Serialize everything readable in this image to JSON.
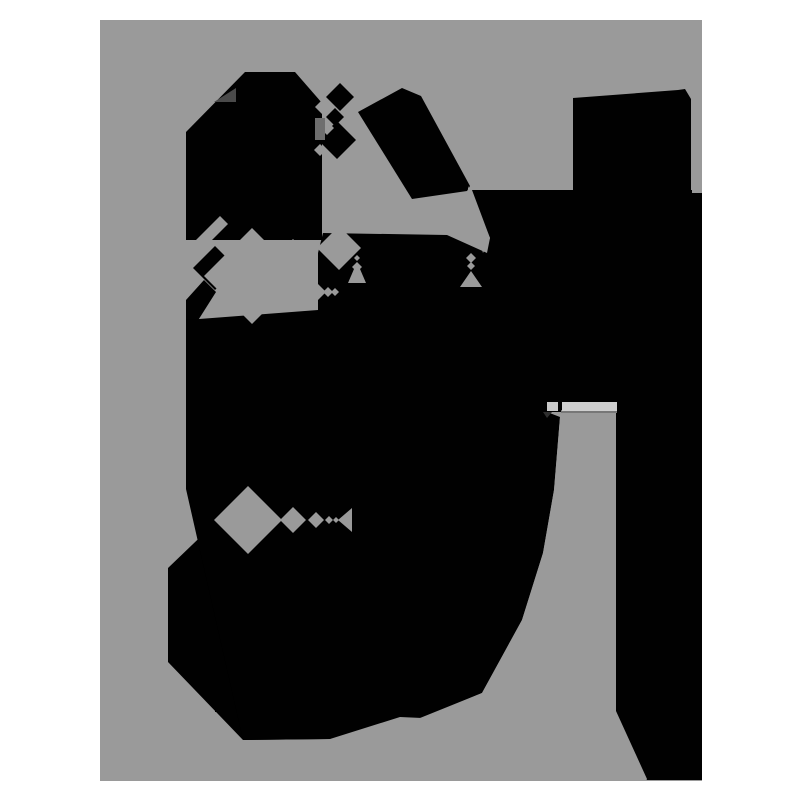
{
  "scene": {
    "description": "abstract-black-shapes-on-gray-canvas",
    "background_color": "#ffffff",
    "canvas": {
      "x": 100,
      "y": 20,
      "width": 602,
      "height": 761,
      "color": "#9a9a9a"
    },
    "palette": {
      "black": "#010101",
      "canvas_gray": "#9a9a9a",
      "dark_accent": "#4a4a4a",
      "mid_accent": "#6e6e6e",
      "bar_light": "#cfcfcf",
      "bar_stub": "#c9c9c9",
      "bar_shadow": "#777777",
      "stub_shadow": "#2e2e2e"
    },
    "shapes": [
      {
        "name": "blob-top-left",
        "type": "polygon",
        "fill": "#010101",
        "points": [
          [
            245,
            72
          ],
          [
            295,
            72
          ],
          [
            322,
            103
          ],
          [
            322,
            240
          ],
          [
            186,
            240
          ],
          [
            186,
            132
          ]
        ]
      },
      {
        "name": "waist-diamond",
        "type": "polygon",
        "fill": "#010101",
        "points": [
          [
            215,
            246
          ],
          [
            237,
            268
          ],
          [
            215,
            290
          ],
          [
            193,
            268
          ]
        ]
      },
      {
        "name": "waist-link",
        "type": "polygon",
        "fill": "#010101",
        "points": [
          [
            186,
            300
          ],
          [
            204,
            280
          ],
          [
            216,
            292
          ],
          [
            197,
            322
          ],
          [
            186,
            322
          ]
        ]
      },
      {
        "name": "left-mass",
        "type": "polygon",
        "fill": "#010101",
        "points": [
          [
            186,
            320
          ],
          [
            370,
            320
          ],
          [
            370,
            700
          ],
          [
            330,
            739
          ],
          [
            243,
            740
          ],
          [
            168,
            662
          ],
          [
            168,
            568
          ],
          [
            217,
            521
          ],
          [
            186,
            489
          ]
        ]
      },
      {
        "name": "central-mass",
        "type": "polygon",
        "fill": "#010101",
        "points": [
          [
            318,
            253
          ],
          [
            323,
            233
          ],
          [
            447,
            235
          ],
          [
            487,
            253
          ],
          [
            547,
            253
          ],
          [
            547,
            412
          ],
          [
            560,
            417
          ],
          [
            554,
            490
          ],
          [
            543,
            553
          ],
          [
            522,
            620
          ],
          [
            482,
            693
          ],
          [
            422,
            718
          ],
          [
            400,
            717
          ],
          [
            330,
            739
          ],
          [
            243,
            740
          ],
          [
            186,
            489
          ],
          [
            186,
            320
          ],
          [
            318,
            310
          ]
        ]
      },
      {
        "name": "slanted-band",
        "type": "polygon",
        "fill": "#010101",
        "points": [
          [
            358,
            112
          ],
          [
            402,
            88
          ],
          [
            421,
            96
          ],
          [
            470,
            186
          ],
          [
            467,
            191
          ],
          [
            412,
            199
          ]
        ]
      },
      {
        "name": "cluster-diamond-top",
        "type": "polygon",
        "fill": "#010101",
        "points": [
          [
            340,
            83
          ],
          [
            354,
            97
          ],
          [
            340,
            111
          ],
          [
            326,
            97
          ]
        ]
      },
      {
        "name": "cluster-diamond-mid",
        "type": "polygon",
        "fill": "#010101",
        "points": [
          [
            335,
            108
          ],
          [
            344,
            117
          ],
          [
            335,
            126
          ],
          [
            326,
            117
          ]
        ]
      },
      {
        "name": "cluster-diamond-bottom",
        "type": "polygon",
        "fill": "#010101",
        "points": [
          [
            337,
            121
          ],
          [
            356,
            140
          ],
          [
            337,
            159
          ],
          [
            318,
            140
          ]
        ]
      },
      {
        "name": "right-mega-mass",
        "type": "polygon",
        "fill": "#010101",
        "points": [
          [
            472,
            190
          ],
          [
            573,
            190
          ],
          [
            573,
            98
          ],
          [
            678,
            90
          ],
          [
            685,
            89
          ],
          [
            691,
            99
          ],
          [
            691,
            190
          ],
          [
            702,
            190
          ],
          [
            702,
            780
          ],
          [
            647,
            780
          ],
          [
            616,
            712
          ],
          [
            616,
            412
          ],
          [
            547,
            412
          ],
          [
            547,
            253
          ],
          [
            487,
            253
          ],
          [
            490,
            238
          ]
        ]
      },
      {
        "name": "tick-line",
        "type": "rect",
        "fill": "#010101",
        "x": 215,
        "y": 710,
        "w": 17,
        "h": 2
      },
      {
        "name": "corner-channel",
        "type": "polygon",
        "fill": "#9a9a9a",
        "points": [
          [
            176,
            260
          ],
          [
            220,
            216
          ],
          [
            228,
            224
          ],
          [
            184,
            268
          ]
        ]
      },
      {
        "name": "big-gray-diamond",
        "type": "polygon",
        "fill": "#9a9a9a",
        "points": [
          [
            252,
            228
          ],
          [
            300,
            276
          ],
          [
            252,
            324
          ],
          [
            204,
            276
          ]
        ]
      },
      {
        "name": "gray-diamond-a",
        "type": "polygon",
        "fill": "#9a9a9a",
        "points": [
          [
            293,
            239
          ],
          [
            311,
            257
          ],
          [
            293,
            275
          ],
          [
            275,
            257
          ]
        ]
      },
      {
        "name": "gray-diamond-b",
        "type": "polygon",
        "fill": "#9a9a9a",
        "points": [
          [
            292,
            270
          ],
          [
            310,
            288
          ],
          [
            292,
            306
          ],
          [
            274,
            288
          ]
        ]
      },
      {
        "name": "gray-diamond-c",
        "type": "polygon",
        "fill": "#9a9a9a",
        "points": [
          [
            339,
            226
          ],
          [
            361,
            248
          ],
          [
            339,
            270
          ],
          [
            317,
            248
          ]
        ]
      },
      {
        "name": "edge-notch-a",
        "type": "polygon",
        "fill": "#9a9a9a",
        "points": [
          [
            323,
            99
          ],
          [
            331,
            107
          ],
          [
            323,
            115
          ],
          [
            315,
            107
          ]
        ]
      },
      {
        "name": "edge-notch-b",
        "type": "polygon",
        "fill": "#9a9a9a",
        "points": [
          [
            327,
            121
          ],
          [
            334,
            128
          ],
          [
            327,
            135
          ],
          [
            320,
            128
          ]
        ]
      },
      {
        "name": "edge-notch-c",
        "type": "polygon",
        "fill": "#9a9a9a",
        "points": [
          [
            320,
            144
          ],
          [
            326,
            150
          ],
          [
            320,
            156
          ],
          [
            314,
            150
          ]
        ]
      },
      {
        "name": "chain292-a",
        "type": "polygon",
        "fill": "#9a9a9a",
        "points": [
          [
            317,
            283
          ],
          [
            326,
            292
          ],
          [
            317,
            301
          ],
          [
            308,
            292
          ]
        ]
      },
      {
        "name": "chain292-b",
        "type": "polygon",
        "fill": "#9a9a9a",
        "points": [
          [
            328,
            287
          ],
          [
            333,
            292
          ],
          [
            328,
            297
          ],
          [
            323,
            292
          ]
        ]
      },
      {
        "name": "chain292-c",
        "type": "polygon",
        "fill": "#9a9a9a",
        "points": [
          [
            335,
            288
          ],
          [
            339,
            292
          ],
          [
            335,
            296
          ],
          [
            331,
            292
          ]
        ]
      },
      {
        "name": "dot-diamond-a",
        "type": "polygon",
        "fill": "#9a9a9a",
        "points": [
          [
            357,
            255
          ],
          [
            360,
            258
          ],
          [
            357,
            261
          ],
          [
            354,
            258
          ]
        ]
      },
      {
        "name": "dot-diamond-b",
        "type": "polygon",
        "fill": "#9a9a9a",
        "points": [
          [
            357,
            262
          ],
          [
            362,
            267
          ],
          [
            357,
            272
          ],
          [
            352,
            267
          ]
        ]
      },
      {
        "name": "wedge-right",
        "type": "polygon",
        "fill": "#9a9a9a",
        "points": [
          [
            357,
            262
          ],
          [
            366,
            283
          ],
          [
            348,
            283
          ]
        ]
      },
      {
        "name": "neck-gap",
        "type": "polygon",
        "fill": "#9a9a9a",
        "points": [
          [
            468,
            186
          ],
          [
            490,
            238
          ],
          [
            483,
            253
          ],
          [
            468,
            203
          ]
        ]
      },
      {
        "name": "drip-diamond-a",
        "type": "polygon",
        "fill": "#9a9a9a",
        "points": [
          [
            471,
            253
          ],
          [
            476,
            258
          ],
          [
            471,
            263
          ],
          [
            466,
            258
          ]
        ]
      },
      {
        "name": "drip-diamond-b",
        "type": "polygon",
        "fill": "#9a9a9a",
        "points": [
          [
            471,
            262
          ],
          [
            475,
            266
          ],
          [
            471,
            270
          ],
          [
            467,
            266
          ]
        ]
      },
      {
        "name": "drip-triangle",
        "type": "polygon",
        "fill": "#9a9a9a",
        "points": [
          [
            460,
            287
          ],
          [
            482,
            287
          ],
          [
            471,
            271
          ]
        ]
      },
      {
        "name": "chain520-big",
        "type": "polygon",
        "fill": "#9a9a9a",
        "points": [
          [
            248,
            486
          ],
          [
            282,
            520
          ],
          [
            248,
            554
          ],
          [
            214,
            520
          ]
        ]
      },
      {
        "name": "chain520-b",
        "type": "polygon",
        "fill": "#9a9a9a",
        "points": [
          [
            293,
            507
          ],
          [
            306,
            520
          ],
          [
            293,
            533
          ],
          [
            280,
            520
          ]
        ]
      },
      {
        "name": "chain520-c",
        "type": "polygon",
        "fill": "#9a9a9a",
        "points": [
          [
            316,
            512
          ],
          [
            324,
            520
          ],
          [
            316,
            528
          ],
          [
            308,
            520
          ]
        ]
      },
      {
        "name": "chain520-d",
        "type": "polygon",
        "fill": "#9a9a9a",
        "points": [
          [
            329,
            516
          ],
          [
            333,
            520
          ],
          [
            329,
            524
          ],
          [
            325,
            520
          ]
        ]
      },
      {
        "name": "chain520-e",
        "type": "polygon",
        "fill": "#9a9a9a",
        "points": [
          [
            336,
            517
          ],
          [
            339,
            520
          ],
          [
            336,
            523
          ],
          [
            333,
            520
          ]
        ]
      },
      {
        "name": "chain520-wedge",
        "type": "polygon",
        "fill": "#9a9a9a",
        "points": [
          [
            352,
            508
          ],
          [
            352,
            532
          ],
          [
            338,
            520
          ]
        ]
      },
      {
        "name": "gray-column",
        "type": "polygon",
        "fill": "#9a9a9a",
        "points": [
          [
            561,
            412
          ],
          [
            616,
            412
          ],
          [
            616,
            711
          ],
          [
            647,
            779
          ],
          [
            420,
            779
          ],
          [
            420,
            718
          ],
          [
            482,
            693
          ],
          [
            522,
            620
          ],
          [
            543,
            553
          ],
          [
            554,
            490
          ],
          [
            560,
            417
          ]
        ]
      },
      {
        "name": "right-edge-strip",
        "type": "rect",
        "fill": "#9a9a9a",
        "x": 692,
        "y": 115,
        "w": 10,
        "h": 78
      },
      {
        "name": "dark-triangle-accent",
        "type": "polygon",
        "fill": "#4a4a4a",
        "points": [
          [
            214,
            102
          ],
          [
            236,
            88
          ],
          [
            236,
            102
          ]
        ]
      },
      {
        "name": "mid-square-accent",
        "type": "rect",
        "fill": "#6e6e6e",
        "x": 315,
        "y": 118,
        "w": 10,
        "h": 22
      },
      {
        "name": "bar-shadow",
        "type": "rect",
        "fill": "#777777",
        "x": 561,
        "y": 410,
        "w": 56,
        "h": 3
      },
      {
        "name": "bar-stub-shadow",
        "type": "polygon",
        "fill": "#2e2e2e",
        "points": [
          [
            543,
            412
          ],
          [
            552,
            412
          ],
          [
            547,
            418
          ]
        ]
      },
      {
        "name": "light-bar-stub",
        "type": "rect",
        "fill": "#c9c9c9",
        "x": 547,
        "y": 402,
        "w": 11,
        "h": 9
      },
      {
        "name": "light-bar-main",
        "type": "rect",
        "fill": "#cfcfcf",
        "x": 562,
        "y": 402,
        "w": 55,
        "h": 9
      }
    ]
  }
}
